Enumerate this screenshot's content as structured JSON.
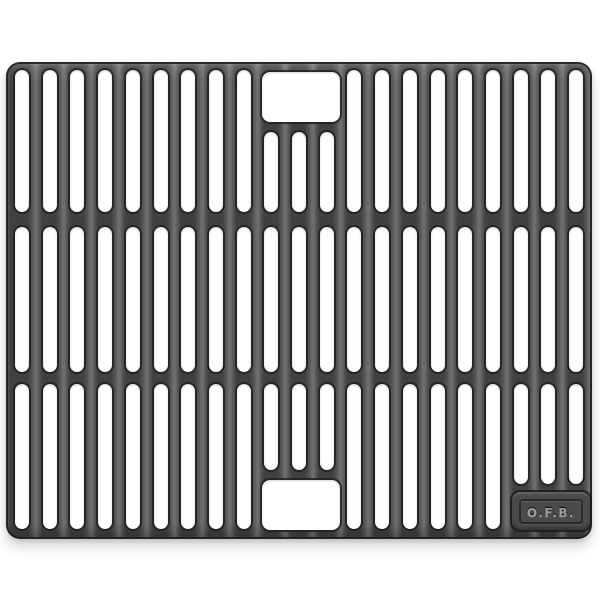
{
  "scene": {
    "description": "Product photo of a black cast-iron grill cooking grate on a plain white background",
    "background_color": "#ffffff"
  },
  "grate": {
    "material": "cast iron",
    "base_color": "#454648",
    "bar_highlight_color": "#6b6d6e",
    "outline_color": "#202122",
    "slot_color": "#ffffff",
    "rows": 3,
    "columns": 21,
    "center_columns": [
      9,
      10,
      11
    ],
    "badge_columns": [
      18,
      19,
      20
    ],
    "handle_openings": 2
  },
  "badge": {
    "text": "O.F.B.",
    "text_color": "#9b9c9e"
  }
}
